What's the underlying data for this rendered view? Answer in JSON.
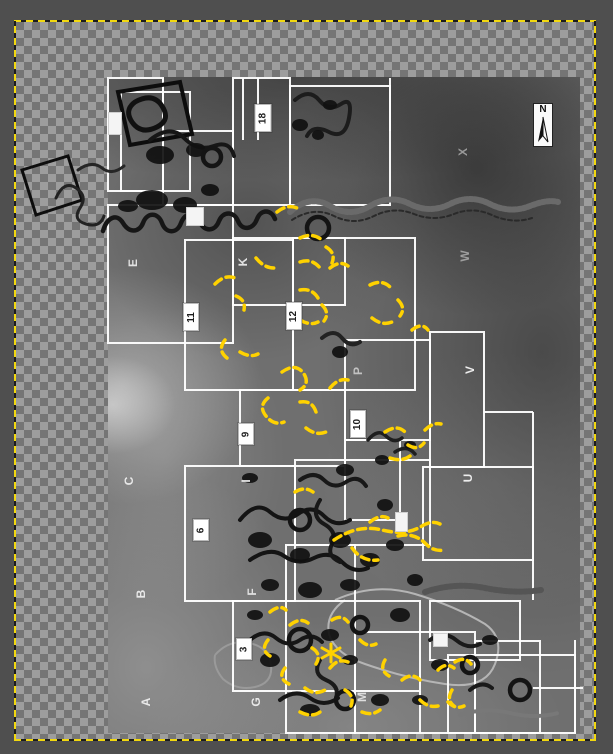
{
  "canvas": {
    "surround_color": "#4f4f4f",
    "checker_light": "#9d9d9d",
    "checker_dark": "#757575",
    "boundary_yellow": "#f2d80f",
    "boundary_black": "#1c1c1c",
    "layer_bounds": {
      "left": 15,
      "top": 21,
      "right": 596,
      "bottom": 741
    }
  },
  "compass": {
    "label": "N"
  },
  "map": {
    "grid_color": "#ffffff",
    "ink_color": "#161616",
    "annotation_color": "#ffd200",
    "photo_base_color": "#6f6f6f",
    "letter_labels": [
      {
        "text": "E",
        "x": 133,
        "y": 263,
        "color": "#e2e2e2"
      },
      {
        "text": "K",
        "x": 243,
        "y": 262,
        "color": "#e2e2e2"
      },
      {
        "text": "X",
        "x": 463,
        "y": 152,
        "color": "#9a9a9a"
      },
      {
        "text": "W",
        "x": 465,
        "y": 256,
        "color": "#9f9f9f"
      },
      {
        "text": "V",
        "x": 470,
        "y": 370,
        "color": "#ededed"
      },
      {
        "text": "U",
        "x": 468,
        "y": 478,
        "color": "#ededed"
      },
      {
        "text": "P",
        "x": 358,
        "y": 371,
        "color": "#c2c2c2"
      },
      {
        "text": "C",
        "x": 129,
        "y": 481,
        "color": "#e8e8e8"
      },
      {
        "text": "I",
        "x": 246,
        "y": 481,
        "color": "#e8e8e8"
      },
      {
        "text": "B",
        "x": 141,
        "y": 594,
        "color": "#e8e8e8"
      },
      {
        "text": "F",
        "x": 252,
        "y": 592,
        "color": "#e0e0e0"
      },
      {
        "text": "A",
        "x": 146,
        "y": 702,
        "color": "#e8e8e8"
      },
      {
        "text": "G",
        "x": 256,
        "y": 702,
        "color": "#e8e8e8"
      },
      {
        "text": "M",
        "x": 362,
        "y": 697,
        "color": "#dedede"
      }
    ],
    "number_labels": [
      {
        "text": "18",
        "x": 263,
        "y": 118,
        "w": 15,
        "h": 26
      },
      {
        "text": "11",
        "x": 191,
        "y": 317,
        "w": 14,
        "h": 26
      },
      {
        "text": "12",
        "x": 294,
        "y": 316,
        "w": 14,
        "h": 26
      },
      {
        "text": "9",
        "x": 246,
        "y": 434,
        "w": 14,
        "h": 20
      },
      {
        "text": "10",
        "x": 358,
        "y": 424,
        "w": 14,
        "h": 26
      },
      {
        "text": "6",
        "x": 201,
        "y": 530,
        "w": 14,
        "h": 20
      },
      {
        "text": "3",
        "x": 244,
        "y": 649,
        "w": 14,
        "h": 20
      }
    ],
    "blank_boxes": [
      {
        "x": 108,
        "y": 112,
        "w": 12,
        "h": 21
      },
      {
        "x": 186,
        "y": 207,
        "w": 16,
        "h": 17
      },
      {
        "x": 395,
        "y": 512,
        "w": 11,
        "h": 18
      },
      {
        "x": 433,
        "y": 633,
        "w": 13,
        "h": 12
      }
    ],
    "rects": [
      [
        108,
        78,
        55,
        113
      ],
      [
        121,
        92,
        69,
        99
      ],
      [
        163,
        131,
        70,
        74
      ],
      [
        233,
        78,
        57,
        127
      ],
      [
        290,
        86,
        100,
        119
      ],
      [
        108,
        205,
        125,
        138
      ],
      [
        185,
        240,
        108,
        150
      ],
      [
        233,
        238,
        112,
        67
      ],
      [
        293,
        238,
        122,
        152
      ],
      [
        345,
        340,
        85,
        100
      ],
      [
        240,
        390,
        105,
        76
      ],
      [
        430,
        332,
        54,
        135
      ],
      [
        423,
        467,
        110,
        93
      ],
      [
        295,
        460,
        135,
        85
      ],
      [
        185,
        466,
        110,
        135
      ],
      [
        345,
        440,
        55,
        80
      ],
      [
        233,
        601,
        187,
        90
      ],
      [
        355,
        632,
        120,
        101
      ],
      [
        430,
        601,
        90,
        59
      ],
      [
        448,
        655,
        127,
        78
      ],
      [
        475,
        641,
        65,
        92
      ],
      [
        286,
        545,
        69,
        188
      ]
    ],
    "lines": [
      [
        243,
        78,
        243,
        140
      ],
      [
        258,
        78,
        258,
        140
      ],
      [
        390,
        78,
        390,
        131
      ],
      [
        163,
        78,
        163,
        131
      ],
      [
        484,
        412,
        533,
        412
      ],
      [
        533,
        412,
        533,
        600
      ],
      [
        575,
        640,
        575,
        733
      ],
      [
        533,
        688,
        583,
        688
      ],
      [
        420,
        691,
        420,
        733
      ]
    ],
    "pale_outlines": [
      {
        "d": "M335,600 q40,-18 80,-6 q40,12 70,30 q20,14 10,40 q-10,26 -50,20 q-40,-6 -80,-20 q-30,-10 -36,-30 q-4,-20 16,-34",
        "w": 2,
        "c": "#b5b5b5"
      },
      {
        "d": "M215,655 q14,-16 34,-12 q20,4 22,22 q2,18 -16,22 q-18,4 -32,-8 q-10,-12 -8,-24",
        "w": 2,
        "c": "#9a9a9a"
      }
    ],
    "ink_paths": [
      {
        "d": "M22,170 l46,-14 l14,44 l-46,15 z",
        "w": 3,
        "c": "#0d0d0d"
      },
      {
        "d": "M118,92 l62,-10 l12,52 l-62,11 z",
        "w": 4,
        "c": "#0d0d0d"
      },
      {
        "d": "M135,102 q18,-10 27,4 q9,14 -5,21 q-16,8 -25,-5 q-8,-12 3,-20",
        "w": 5,
        "c": "#111111"
      },
      {
        "d": "M56,198 q8,-18 20,-10 q12,8 4,20 q-8,12 6,16 q14,4 18,-8",
        "w": 3,
        "c": "#222222"
      },
      {
        "d": "M78,170 q14,-10 24,-2 q10,8 22,-2",
        "w": 3,
        "c": "#262626"
      },
      {
        "d": "M103,231 c4,-14 14,-18 20,-8 c6,10 16,10 20,0 c4,-11 15,-11 19,0 c4,11 15,11 19,0 c4,-11 15,-12 19,-1 c4,10 15,10 19,-1 c4,-10 15,-10 19,0 c4,10 15,9 19,-2 c4,-10 14,-10 18,0",
        "w": 4.5,
        "c": "#161616"
      },
      {
        "d": "M290,212 q20,-18 40,-6 q20,12 40,0 q20,-12 40,-2 q20,10 40,0 q20,-10 40,0 q20,10 40,2 q18,-7 28,-4",
        "w": 6,
        "c": "#6a6a6a",
        "dash": "3 2"
      },
      {
        "d": "M292,220 q22,-14 42,-4 q20,10 40,0 q20,-10 40,-2 q20,8 40,0 q20,-8 40,2 q20,8 38,2",
        "w": 2,
        "c": "#2a2a2a",
        "dash": "4 3"
      },
      {
        "d": "M150,140 q20,-16 34,-2 q14,14 30,8 q16,-6 20,10",
        "w": 4,
        "c": "#161616"
      },
      {
        "d": "M295,100 q14,-12 24,0 q10,12 22,4 q12,-8 8,14 q-4,22 -20,14 q-16,-8 -22,4",
        "w": 4,
        "c": "#1c1c1c"
      },
      {
        "d": "M322,338 q12,-10 20,0 q8,10 18,4",
        "w": 4,
        "c": "#222222"
      },
      {
        "d": "M368,440 q10,-12 18,-4 q8,8 16,2",
        "w": 3.5,
        "c": "#1e1e1e"
      },
      {
        "d": "M395,452 q12,-8 20,2",
        "w": 3.5,
        "c": "#1e1e1e"
      },
      {
        "d": "M240,520 q16,-20 30,-8 q14,12 28,2 q14,-10 26,2 q12,12 26,4",
        "w": 4,
        "c": "#141414"
      },
      {
        "d": "M250,560 q20,-14 34,-4 q14,10 30,2 q16,-8 28,4 q12,12 26,6",
        "w": 4,
        "c": "#141414"
      },
      {
        "d": "M300,480 q14,-10 24,0 q10,10 22,2 q12,-8 20,4",
        "w": 4,
        "c": "#181818"
      },
      {
        "d": "M320,500 q-10,16 4,24 q14,8 8,20 q-6,12 8,18",
        "w": 4,
        "c": "#181818"
      },
      {
        "d": "M250,640 q14,-12 26,-2 q12,10 24,2 q12,-8 22,2",
        "w": 4,
        "c": "#161616"
      },
      {
        "d": "M280,700 q16,-12 30,-2 q14,10 28,0",
        "w": 4,
        "c": "#161616"
      },
      {
        "d": "M320,660 q-8,14 6,20 q14,6 10,18",
        "w": 4,
        "c": "#1a1a1a"
      },
      {
        "d": "M430,640 q14,-10 26,0 q12,10 24,4",
        "w": 4,
        "c": "#1a1a1a"
      },
      {
        "d": "M470,690 q12,-10 22,-2",
        "w": 4,
        "c": "#1a1a1a"
      },
      {
        "d": "M425,592 q30,-10 60,-4 q30,6 56,2",
        "w": 6,
        "c": "#555555",
        "dash": "3 2"
      },
      {
        "d": "M460,715 q25,-8 50,-2 q25,6 48,0",
        "w": 4,
        "c": "#787878",
        "dash": "3 2"
      }
    ],
    "blobs": [
      [
        160,
        155,
        14,
        9
      ],
      [
        196,
        150,
        10,
        7
      ],
      [
        152,
        200,
        16,
        10
      ],
      [
        185,
        205,
        12,
        8
      ],
      [
        210,
        190,
        9,
        6
      ],
      [
        128,
        206,
        10,
        6
      ],
      [
        300,
        125,
        8,
        6
      ],
      [
        330,
        105,
        7,
        5
      ],
      [
        318,
        135,
        6,
        5
      ],
      [
        340,
        352,
        8,
        6
      ],
      [
        382,
        460,
        7,
        5
      ],
      [
        410,
        445,
        6,
        4
      ],
      [
        260,
        540,
        12,
        8
      ],
      [
        300,
        555,
        10,
        7
      ],
      [
        340,
        540,
        11,
        8
      ],
      [
        370,
        560,
        10,
        7
      ],
      [
        310,
        590,
        12,
        8
      ],
      [
        350,
        585,
        10,
        6
      ],
      [
        395,
        545,
        9,
        6
      ],
      [
        270,
        585,
        9,
        6
      ],
      [
        385,
        505,
        8,
        6
      ],
      [
        345,
        470,
        9,
        6
      ],
      [
        250,
        478,
        8,
        5
      ],
      [
        415,
        580,
        8,
        6
      ],
      [
        270,
        660,
        10,
        7
      ],
      [
        330,
        635,
        9,
        6
      ],
      [
        400,
        615,
        10,
        7
      ],
      [
        440,
        665,
        9,
        6
      ],
      [
        310,
        710,
        10,
        6
      ],
      [
        380,
        700,
        9,
        6
      ],
      [
        490,
        640,
        8,
        5
      ],
      [
        350,
        660,
        8,
        5
      ],
      [
        420,
        700,
        8,
        5
      ],
      [
        255,
        615,
        8,
        5
      ]
    ],
    "rings": [
      [
        212,
        157,
        9
      ],
      [
        318,
        228,
        11
      ],
      [
        300,
        520,
        10
      ],
      [
        300,
        640,
        11
      ],
      [
        345,
        700,
        9
      ],
      [
        470,
        665,
        8
      ],
      [
        520,
        690,
        10
      ],
      [
        360,
        625,
        8
      ]
    ],
    "yellow_paths": [
      "M277,212 q10,-8 20,-4",
      "M300,238 q12,-6 22,2",
      "M326,247 q10,6 6,16",
      "M256,258 q8,10 18,10",
      "M300,262 q12,-4 20,6",
      "M330,268 q10,-8 18,-2",
      "M215,284 q10,-10 20,-6",
      "M236,296 q10,4 8,14",
      "M225,340 q-8,10 2,18",
      "M240,352 q10,6 18,2",
      "M300,290 q12,-2 18,8",
      "M322,305 q8,8 2,16",
      "M300,320 q10,6 18,2",
      "M370,285 q12,-6 20,2",
      "M398,300 q8,8 2,16",
      "M372,318 q10,8 20,4",
      "M412,330 q10,-8 16,0",
      "M282,372 q14,-10 22,2 q6,10 -4,16",
      "M268,398 q-10,8 -2,18 q8,10 18,6",
      "M300,402 q12,-2 16,10",
      "M306,428 q10,8 20,4",
      "M330,388 q8,-10 18,-8",
      "M385,432 q12,-8 20,0",
      "M408,445 q10,6 16,-2",
      "M390,458 q12,4 20,-2",
      "M425,430 q8,-8 16,-6",
      "M334,540 q24,-16 48,-10 q24,6 40,-4 q10,-6 18,-2",
      "M352,548 q10,14 26,12",
      "M398,536 q16,-4 28,8 q8,8 18,6",
      "M370,522 q10,-8 18,-4",
      "M295,492 q10,-6 18,0",
      "M268,640 q-8,10 2,16",
      "M290,625 q10,-8 18,-2",
      "M312,648 q10,6 4,16",
      "M285,668 q-8,10 4,16",
      "M305,688 q10,8 20,2",
      "M330,668 q8,-10 18,-6",
      "M345,690 q10,6 6,16",
      "M362,712 q10,4 18,-2",
      "M385,660 q-6,10 4,16",
      "M402,680 q10,-8 18,0",
      "M420,700 q8,8 18,6",
      "M438,670 q8,-8 16,-2",
      "M452,690 q-6,10 2,16",
      "M300,712 q12,6 20,0",
      "M332,620 q10,-6 16,2",
      "M270,612 q10,-8 16,-2",
      "M360,640 q8,8 16,4",
      "M455,662 q10,-6 16,2",
      "M448,702 q8,8 16,4"
    ],
    "yellow_star": "M322,648 l18,10 M340,648 l-18,10 M331,644 l0,18"
  }
}
